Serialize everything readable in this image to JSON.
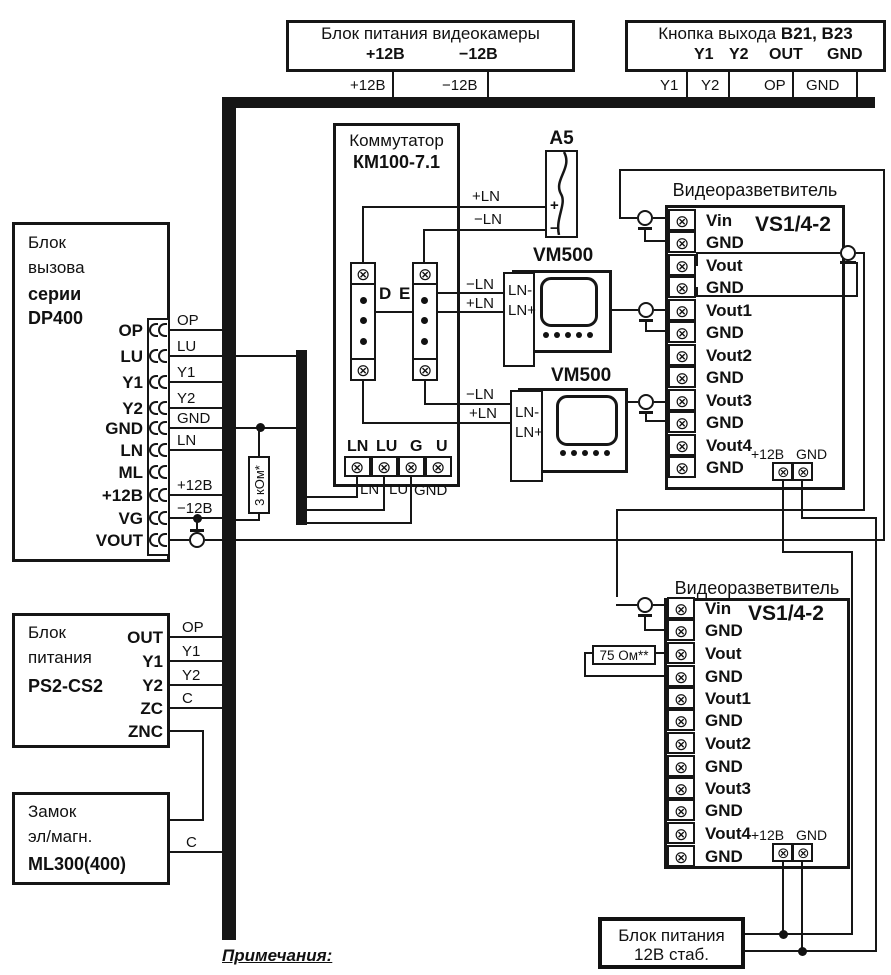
{
  "icons": {
    "screw": "⊗"
  },
  "top": {
    "camera_psu": {
      "title": "Блок питания видеокамеры",
      "t_plus": "+12В",
      "t_minus": "−12В",
      "w_plus": "+12В",
      "w_minus": "−12В"
    },
    "exit_button": {
      "title": "Кнопка выхода ",
      "title_bold": "В21, В23",
      "t1": "Y1",
      "t2": "Y2",
      "t3": "OUT",
      "t4": "GND",
      "w1": "Y1",
      "w2": "Y2",
      "w3": "OP",
      "w4": "GND"
    }
  },
  "call_block": {
    "l1": "Блок",
    "l2": "вызова",
    "l3": "серии",
    "l4": "DP400",
    "terminals": [
      "OP",
      "LU",
      "Y1",
      "Y2",
      "GND",
      "LN",
      "ML",
      "+12В",
      "VG",
      "VOUT"
    ],
    "wire_labels": [
      "OP",
      "LU",
      "Y1",
      "Y2",
      "GND",
      "LN",
      "+12В",
      "−12В"
    ]
  },
  "commutator": {
    "title": "Коммутатор",
    "model": "КМ100-7.1",
    "col_d": "D",
    "col_e": "E",
    "plus_ln": "+LN",
    "minus_ln": "−LN",
    "bottom_terminals": [
      "LN",
      "LU",
      "G",
      "U"
    ],
    "bottom_wires": [
      "LN",
      "LU",
      "GND"
    ]
  },
  "camera_a5": {
    "label": "А5",
    "plus": "+",
    "minus": "−"
  },
  "monitors": [
    {
      "name": "VM500",
      "t1": "LN-",
      "t2": "LN+"
    },
    {
      "name": "VM500",
      "t1": "LN-",
      "t2": "LN+"
    }
  ],
  "splitters": [
    {
      "title": "Видеоразветвитель",
      "model": "VS1/4-2",
      "p1": "+12В",
      "p2": "GND",
      "rows": [
        "Vin",
        "GND",
        "Vout",
        "GND",
        "Vout1",
        "GND",
        "Vout2",
        "GND",
        "Vout3",
        "GND",
        "Vout4",
        "GND"
      ]
    },
    {
      "title": "Видеоразветвитель",
      "model": "VS1/4-2",
      "p1": "+12В",
      "p2": "GND",
      "rows": [
        "Vin",
        "GND",
        "Vout",
        "GND",
        "Vout1",
        "GND",
        "Vout2",
        "GND",
        "Vout3",
        "GND",
        "Vout4",
        "GND"
      ]
    }
  ],
  "psu_block": {
    "l1": "Блок",
    "l2": "питания",
    "l3": "PS2-CS2",
    "terminals": [
      "OUT",
      "Y1",
      "Y2",
      "ZC",
      "ZNC"
    ],
    "wire_labels": [
      "OP",
      "Y1",
      "Y2",
      "C"
    ]
  },
  "lock": {
    "l1": "Замок",
    "l2": "эл/магн.",
    "l3": "ML300(400)",
    "wire_label": "C"
  },
  "psu_12v": {
    "l1": "Блок питания",
    "l2": "12В стаб."
  },
  "resistors": {
    "r1": "3 кОм*",
    "r2": "75 Ом**"
  },
  "note": "Примечания:"
}
